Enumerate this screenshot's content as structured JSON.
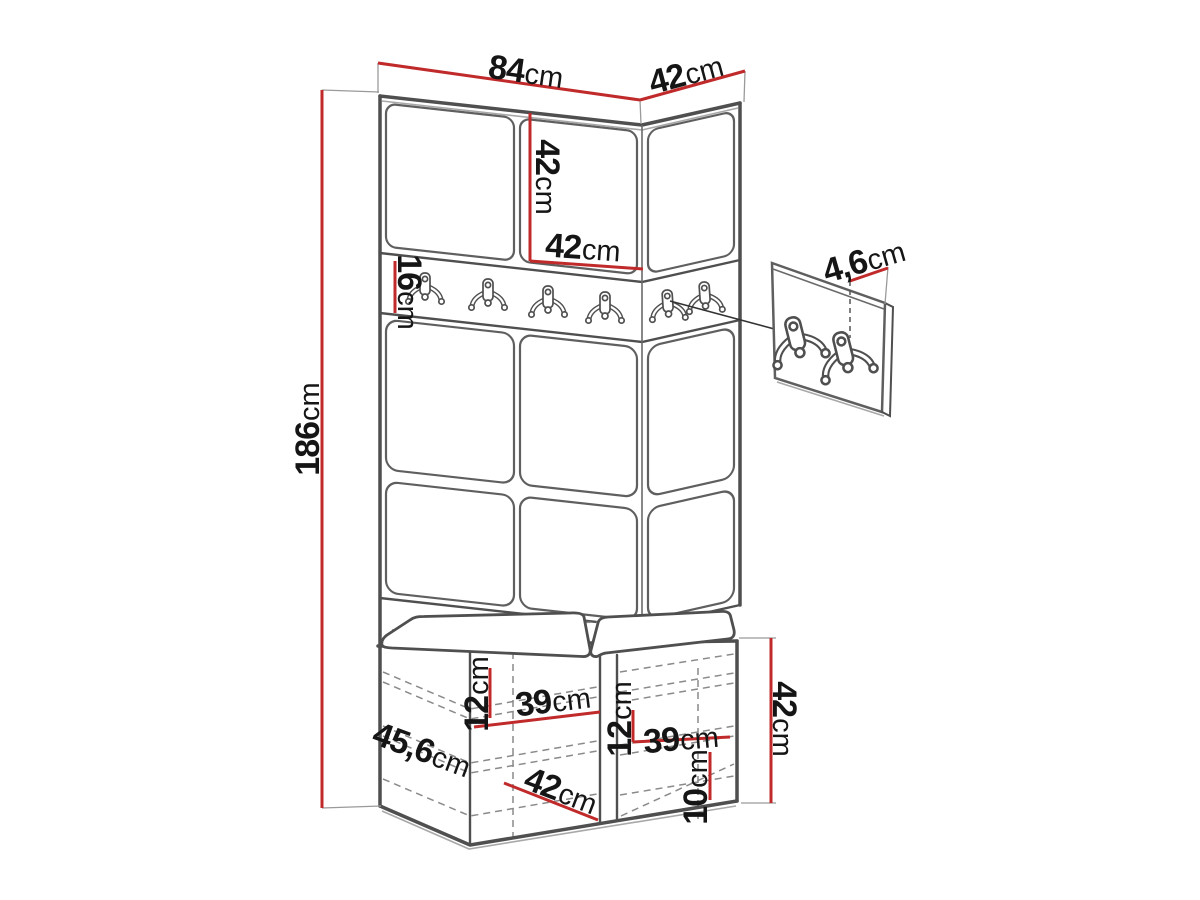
{
  "diagram": {
    "type": "furniture-dimension-drawing",
    "subject": "hallway wardrobe set with coat hook rail, upholstered wall panels and shoe bench",
    "hooks": {
      "main_rail_count": 6,
      "detail_panel_count": 2
    }
  },
  "colors": {
    "dimension_red": "#c12a2a",
    "line_dark": "#4f4f4f",
    "text": "#151515",
    "background": "#ffffff"
  },
  "dimensions": {
    "top_width": {
      "value": "84",
      "unit": "cm"
    },
    "top_right_depth": {
      "value": "42",
      "unit": "cm"
    },
    "upper_cabinet_height": {
      "value": "42",
      "unit": "cm"
    },
    "upper_cabinet_width": {
      "value": "42",
      "unit": "cm"
    },
    "hook_rail_height": {
      "value": "16",
      "unit": "cm"
    },
    "total_height": {
      "value": "186",
      "unit": "cm"
    },
    "hook_panel_depth": {
      "value": "4,6",
      "unit": "cm"
    },
    "bench_depth": {
      "value": "45,6",
      "unit": "cm"
    },
    "shelf_gap_left": {
      "value": "12",
      "unit": "cm"
    },
    "shelf_width_left": {
      "value": "39",
      "unit": "cm"
    },
    "bench_front_width": {
      "value": "42",
      "unit": "cm"
    },
    "shelf_gap_right": {
      "value": "12",
      "unit": "cm"
    },
    "shelf_width_right": {
      "value": "39",
      "unit": "cm"
    },
    "bottom_shelf_gap": {
      "value": "10",
      "unit": "cm"
    },
    "bench_height": {
      "value": "42",
      "unit": "cm"
    }
  }
}
